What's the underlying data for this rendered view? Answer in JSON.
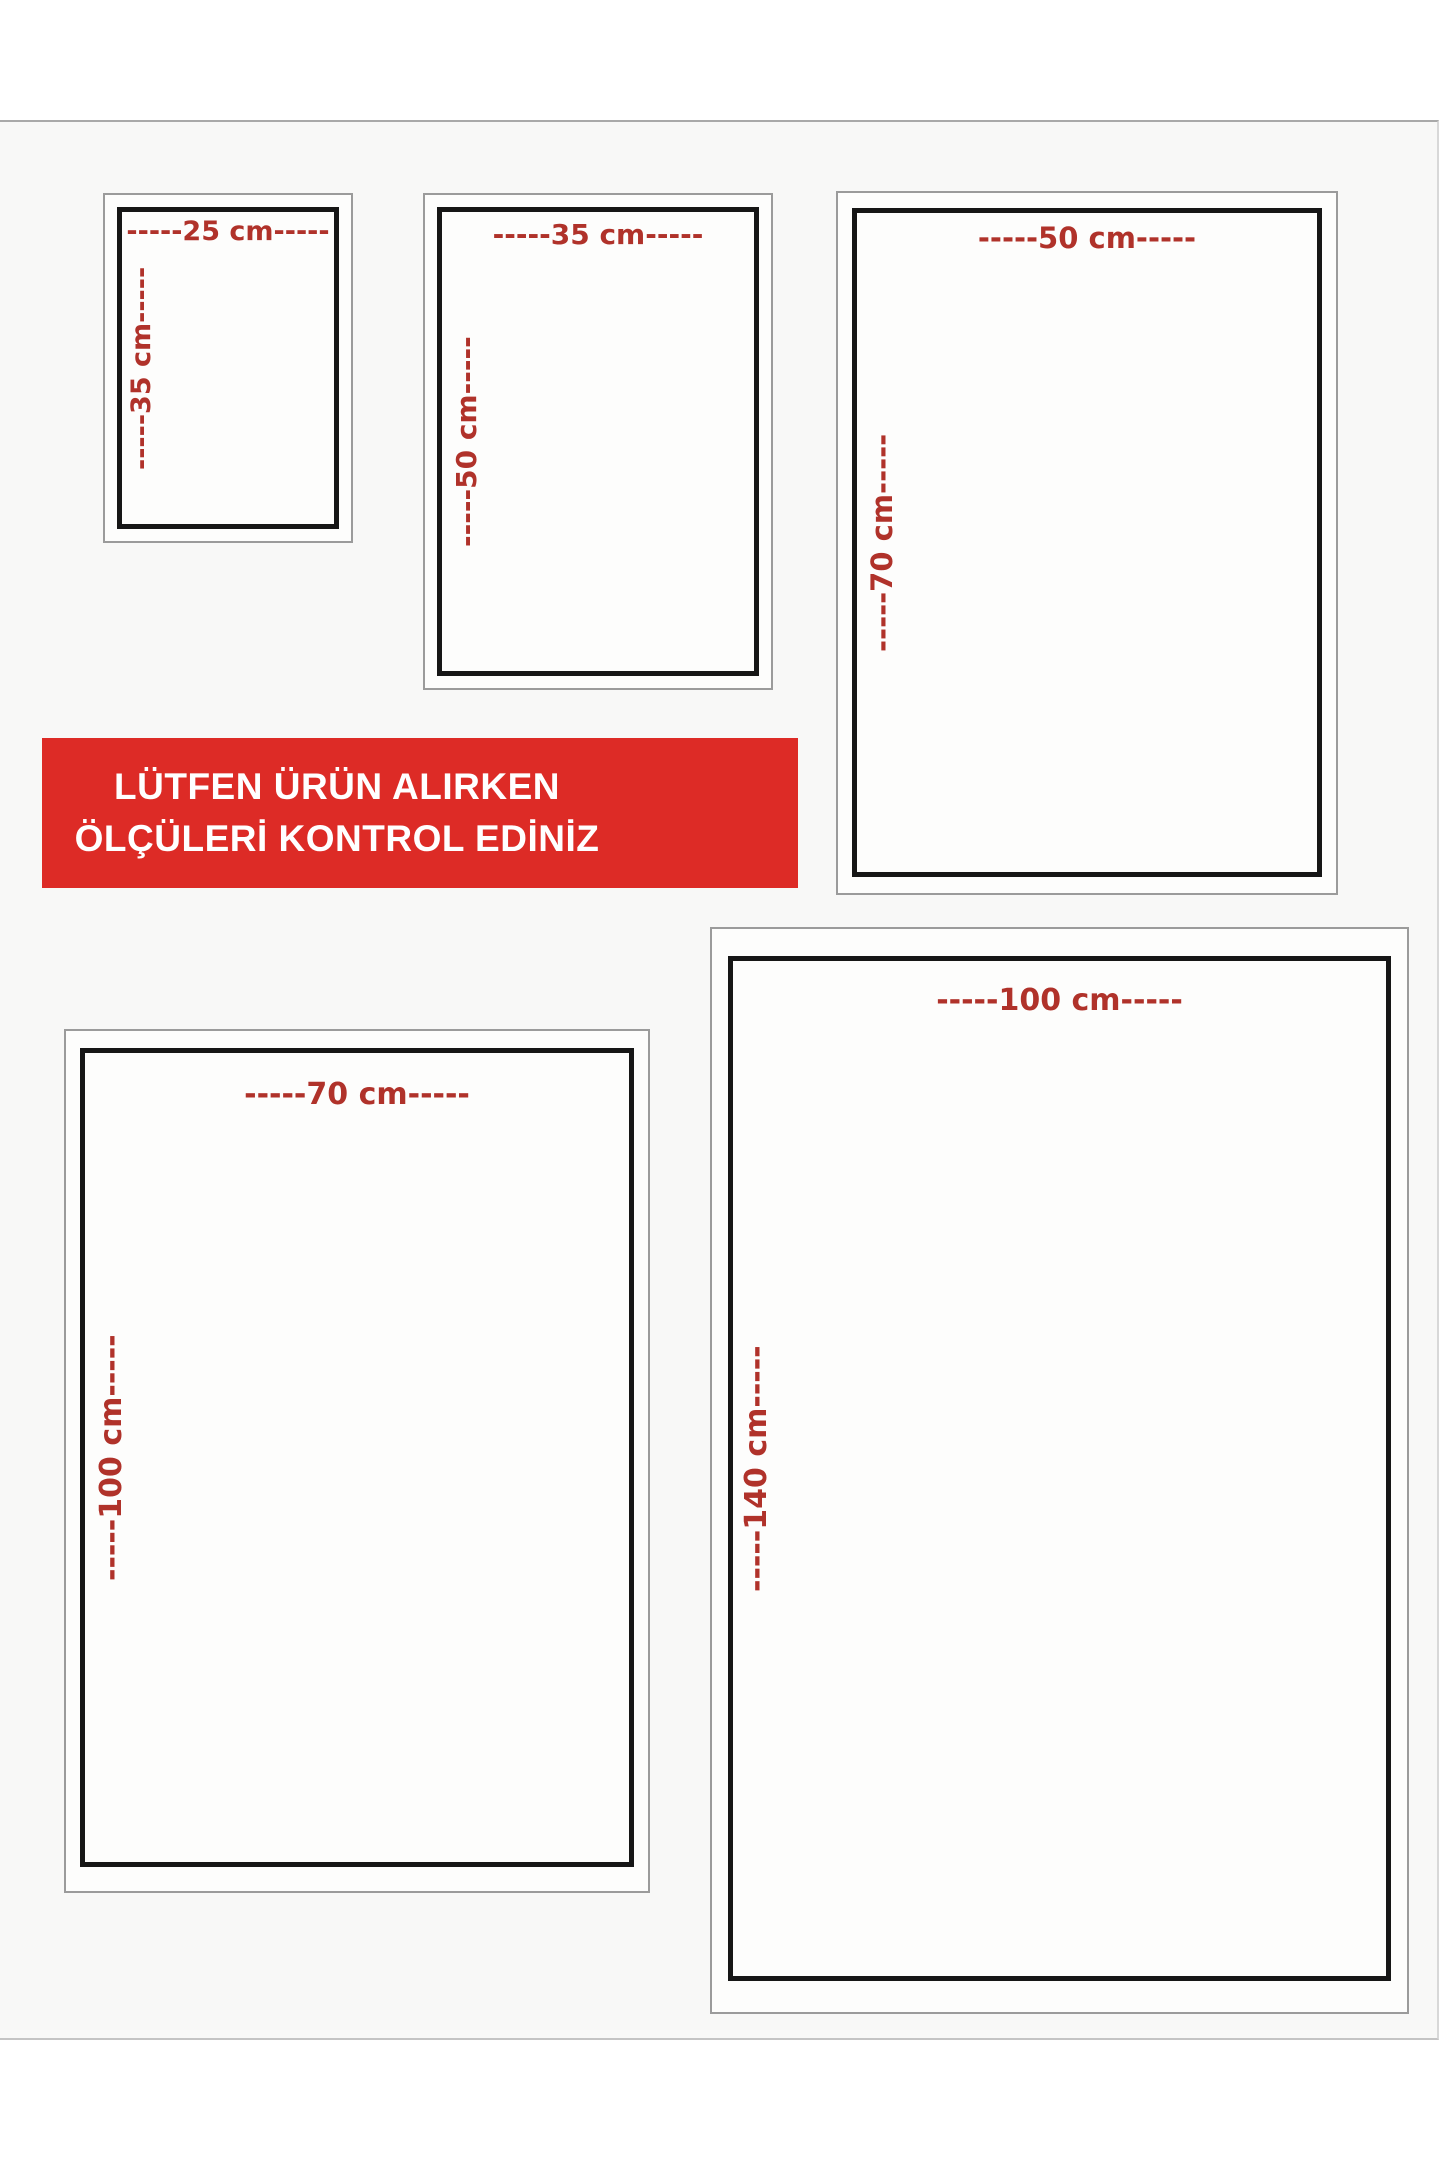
{
  "page": {
    "background": "#ffffff",
    "sheet_background": "#f8f8f7"
  },
  "banner": {
    "line1": "LÜTFEN ÜRÜN ALIRKEN",
    "line2": "ÖLÇÜLERİ KONTROL EDİNİZ",
    "background_color": "#dd2b26",
    "text_color": "#ffffff"
  },
  "colors": {
    "dimension_label_red": "#b0322a",
    "inner_frame_black": "#161616",
    "outer_frame_gray": "#9b9b9b"
  },
  "size_cards": [
    {
      "name": "25x35",
      "width_cm": 25,
      "height_cm": 35,
      "width_label": "-----25 cm-----",
      "height_label": "-----35 cm-----"
    },
    {
      "name": "35x50",
      "width_cm": 35,
      "height_cm": 50,
      "width_label": "-----35 cm-----",
      "height_label": "-----50 cm-----"
    },
    {
      "name": "50x70",
      "width_cm": 50,
      "height_cm": 70,
      "width_label": "-----50 cm-----",
      "height_label": "-----70 cm-----"
    },
    {
      "name": "70x100",
      "width_cm": 70,
      "height_cm": 100,
      "width_label": "-----70 cm-----",
      "height_label": "-----100 cm-----"
    },
    {
      "name": "100x140",
      "width_cm": 100,
      "height_cm": 140,
      "width_label": "-----100 cm-----",
      "height_label": "-----140 cm-----"
    }
  ]
}
